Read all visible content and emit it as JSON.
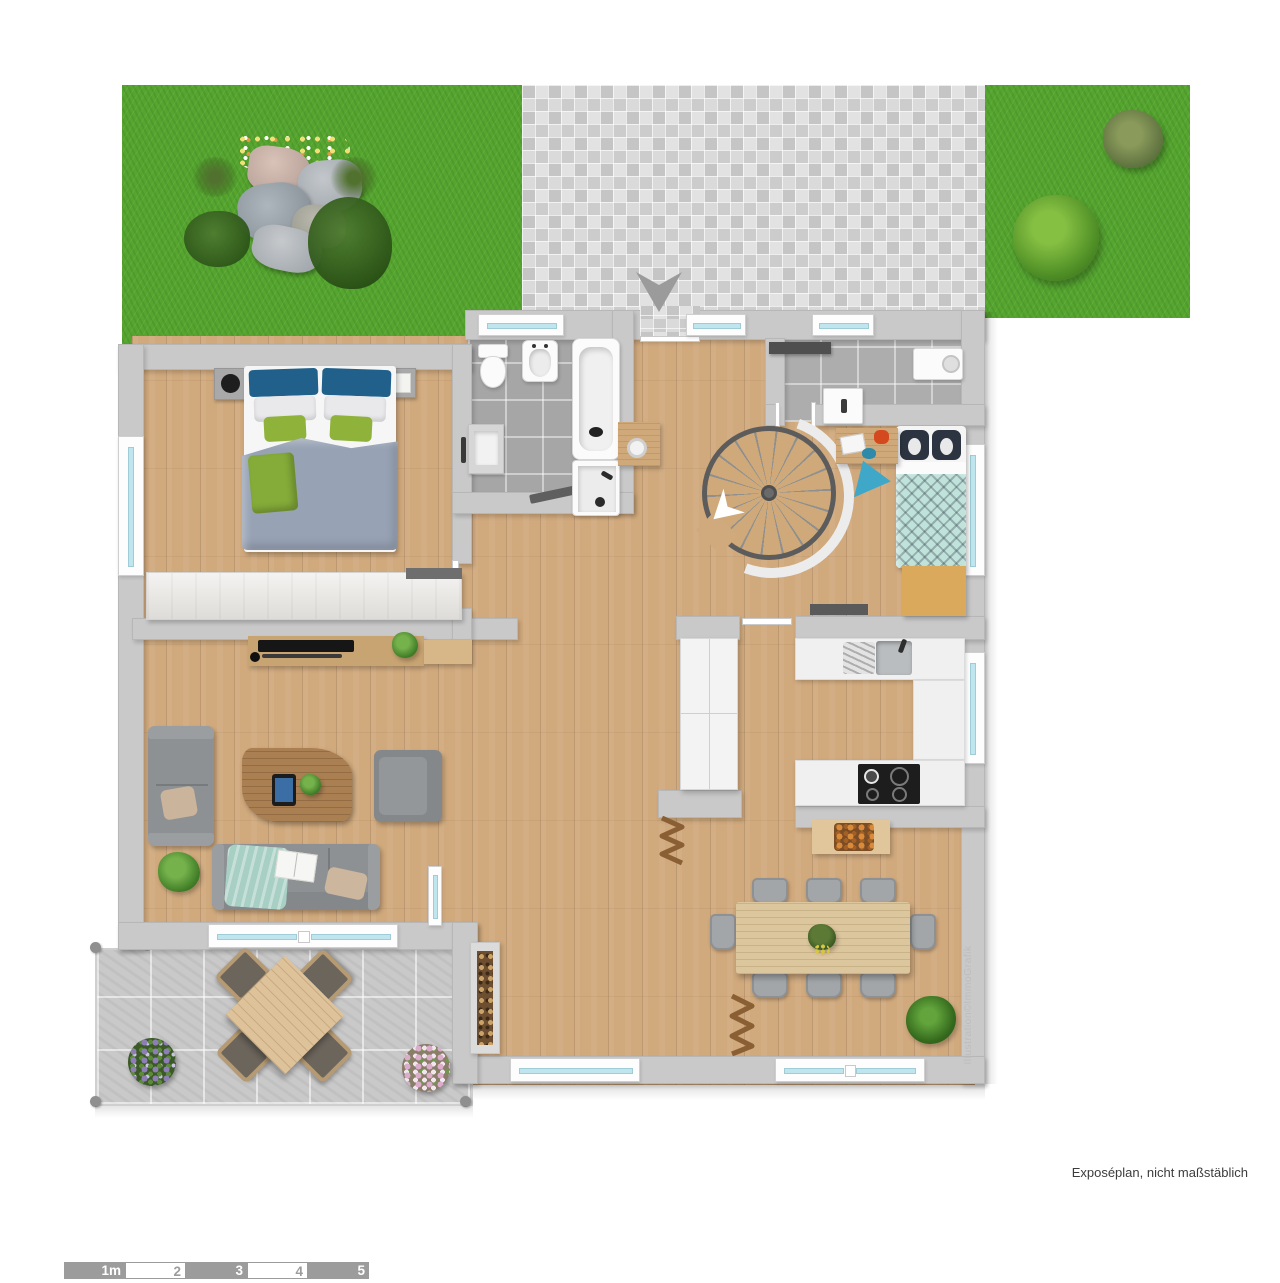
{
  "plan": {
    "footer_note": "Exposéplan, nicht maßstäblich",
    "attribution": "Illustration©ImmoGrafik",
    "scale_bar": {
      "labels": [
        "1m",
        "2",
        "3",
        "4",
        "5"
      ]
    }
  },
  "colors": {
    "grass": "#55a52f",
    "paving": "#d6d6d6",
    "wood": "#d0a97d",
    "wall": "#c9c9c9",
    "tile": "#a6a6a6",
    "terrace-tile": "#c9c9c9",
    "glass": "#bfe6ee",
    "sofa": "#8e9194",
    "duvet": "#97a2b4",
    "pillow-blue": "#20608a",
    "cushion-green": "#8fb23b",
    "kids-mint": "#bfe2da",
    "counter": "#f0f0f0",
    "cooktop": "#1d1d1d",
    "stair-wood": "#cfa979",
    "rail": "#5c5c5c",
    "scalebar": "#9c9c9c",
    "note-text": "#3c3c3c",
    "credit-text": "#bdbdbd"
  }
}
